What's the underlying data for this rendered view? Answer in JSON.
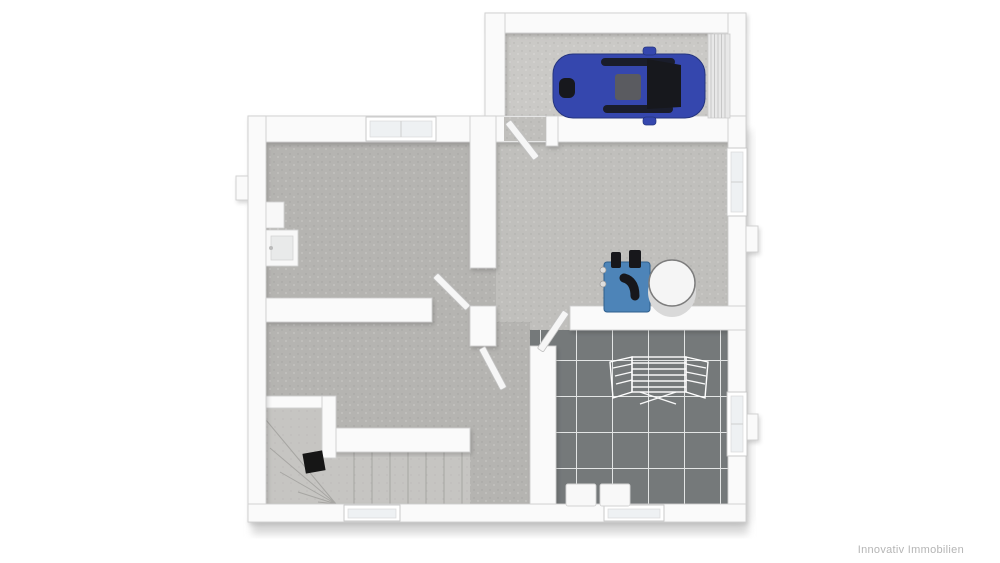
{
  "watermark": {
    "label": "Innovativ Immobilien"
  },
  "colors": {
    "background": "#ffffff",
    "wall": "#fafafa",
    "wall_edge": "#cfcfcf",
    "door": "#f6f6f6",
    "window_glass": "#eef1f3",
    "floor_garage": "#cac9c6",
    "floor_room": "#b5b4b1",
    "floor_hall": "#c0bfbc",
    "floor_stair": "#c6c5c2",
    "tile": "#75797a",
    "grout": "#e3e5e5",
    "car_body": "#3547ae",
    "car_glass": "#17181d",
    "car_roof": "#5a5b60",
    "heater": "#4d84b8",
    "heater_dark": "#17171b",
    "tank": "#f5f5f5",
    "stair_post": "#161616",
    "watermark": "#b5b5b5",
    "shadow": "#d8d8d8"
  },
  "semantics": {
    "view": "3d-floor-plan-top-view",
    "rooms": [
      "garage",
      "room-top-left",
      "hallway-utility",
      "stair-hall",
      "laundry-room"
    ],
    "fixtures": {
      "car": "blue car",
      "garage_door": "sectional garage door",
      "heating_unit": "blue heating unit",
      "tank": "hot water tank",
      "drying_rack": "wire drying rack",
      "appliance_1": "washing machine",
      "appliance_2": "dryer",
      "stairs": "winder staircase",
      "basin": "wash basin"
    },
    "window_count": 5,
    "door_count": 4
  }
}
